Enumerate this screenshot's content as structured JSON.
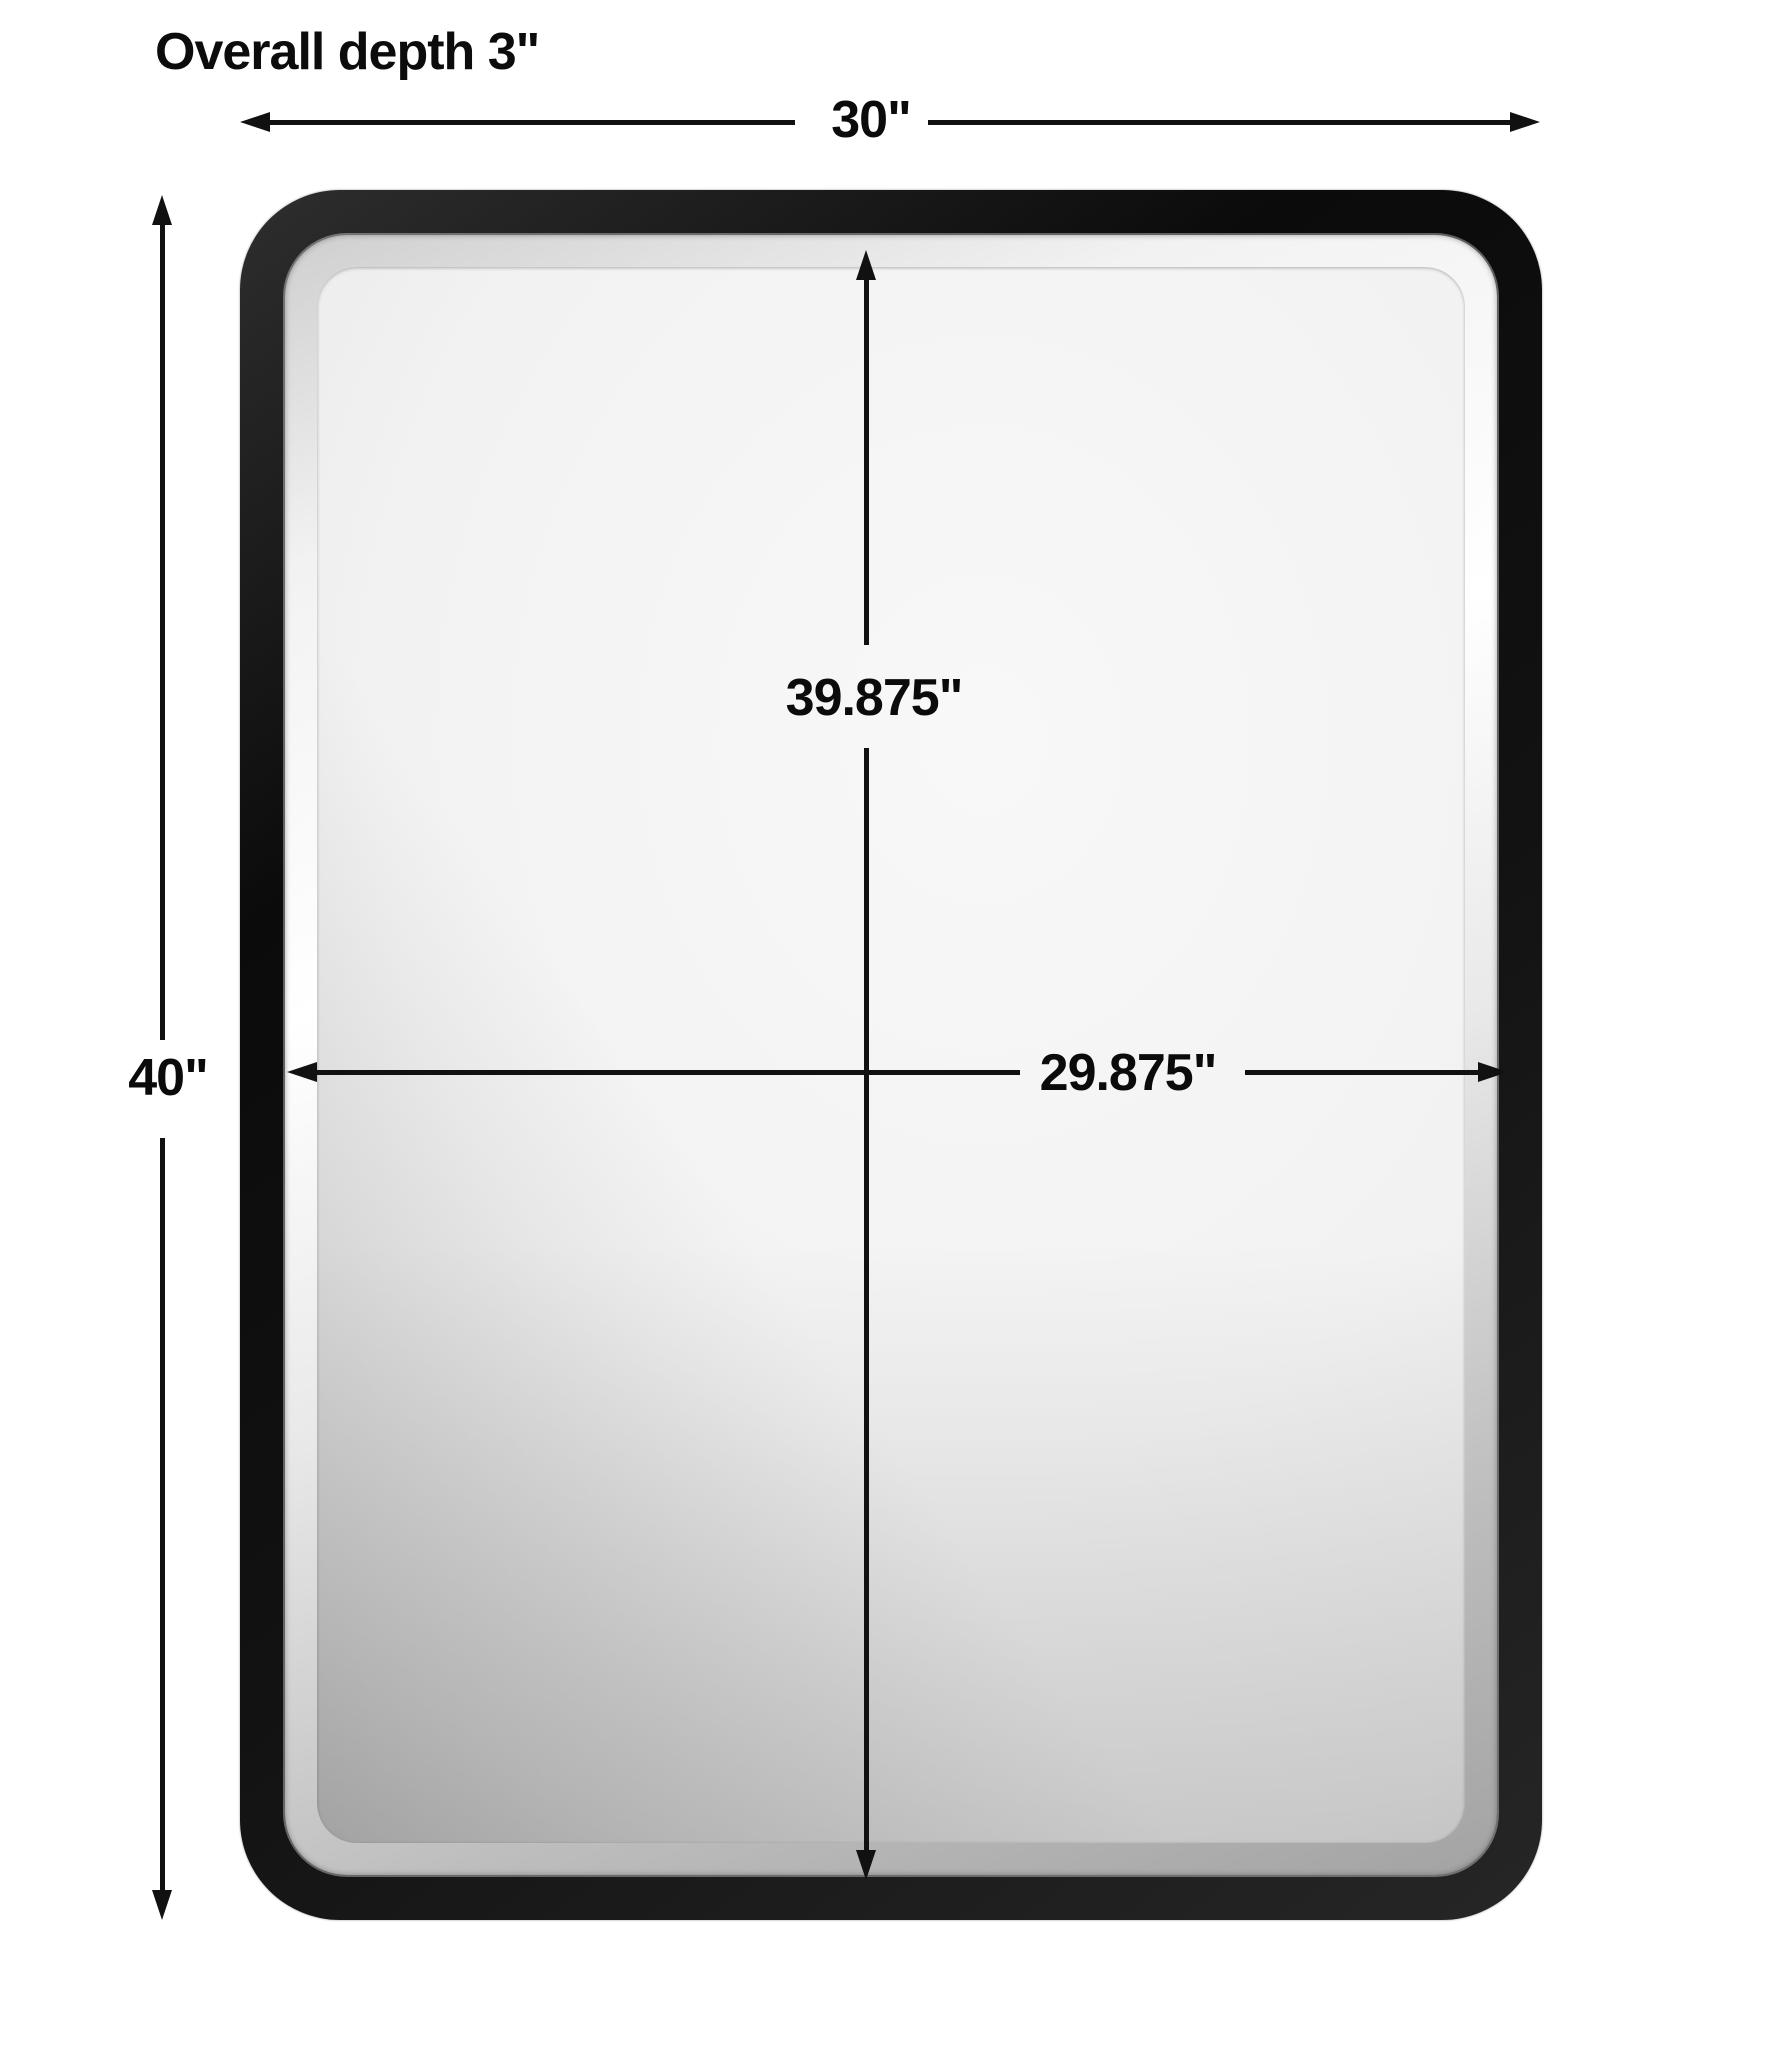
{
  "title": "Overall depth 3\"",
  "dimensions": {
    "overall_width": "30\"",
    "overall_height": "40\"",
    "mirror_height": "39.875\"",
    "mirror_width": "29.875\""
  },
  "colors": {
    "background": "#ffffff",
    "frame": "#141414",
    "bevel_silver": "#d8d8d8",
    "glass_center": "#f4f4f4",
    "glass_edge": "#bdbdbd",
    "dimension_lines": "#111111",
    "text": "#0c0c0c"
  }
}
